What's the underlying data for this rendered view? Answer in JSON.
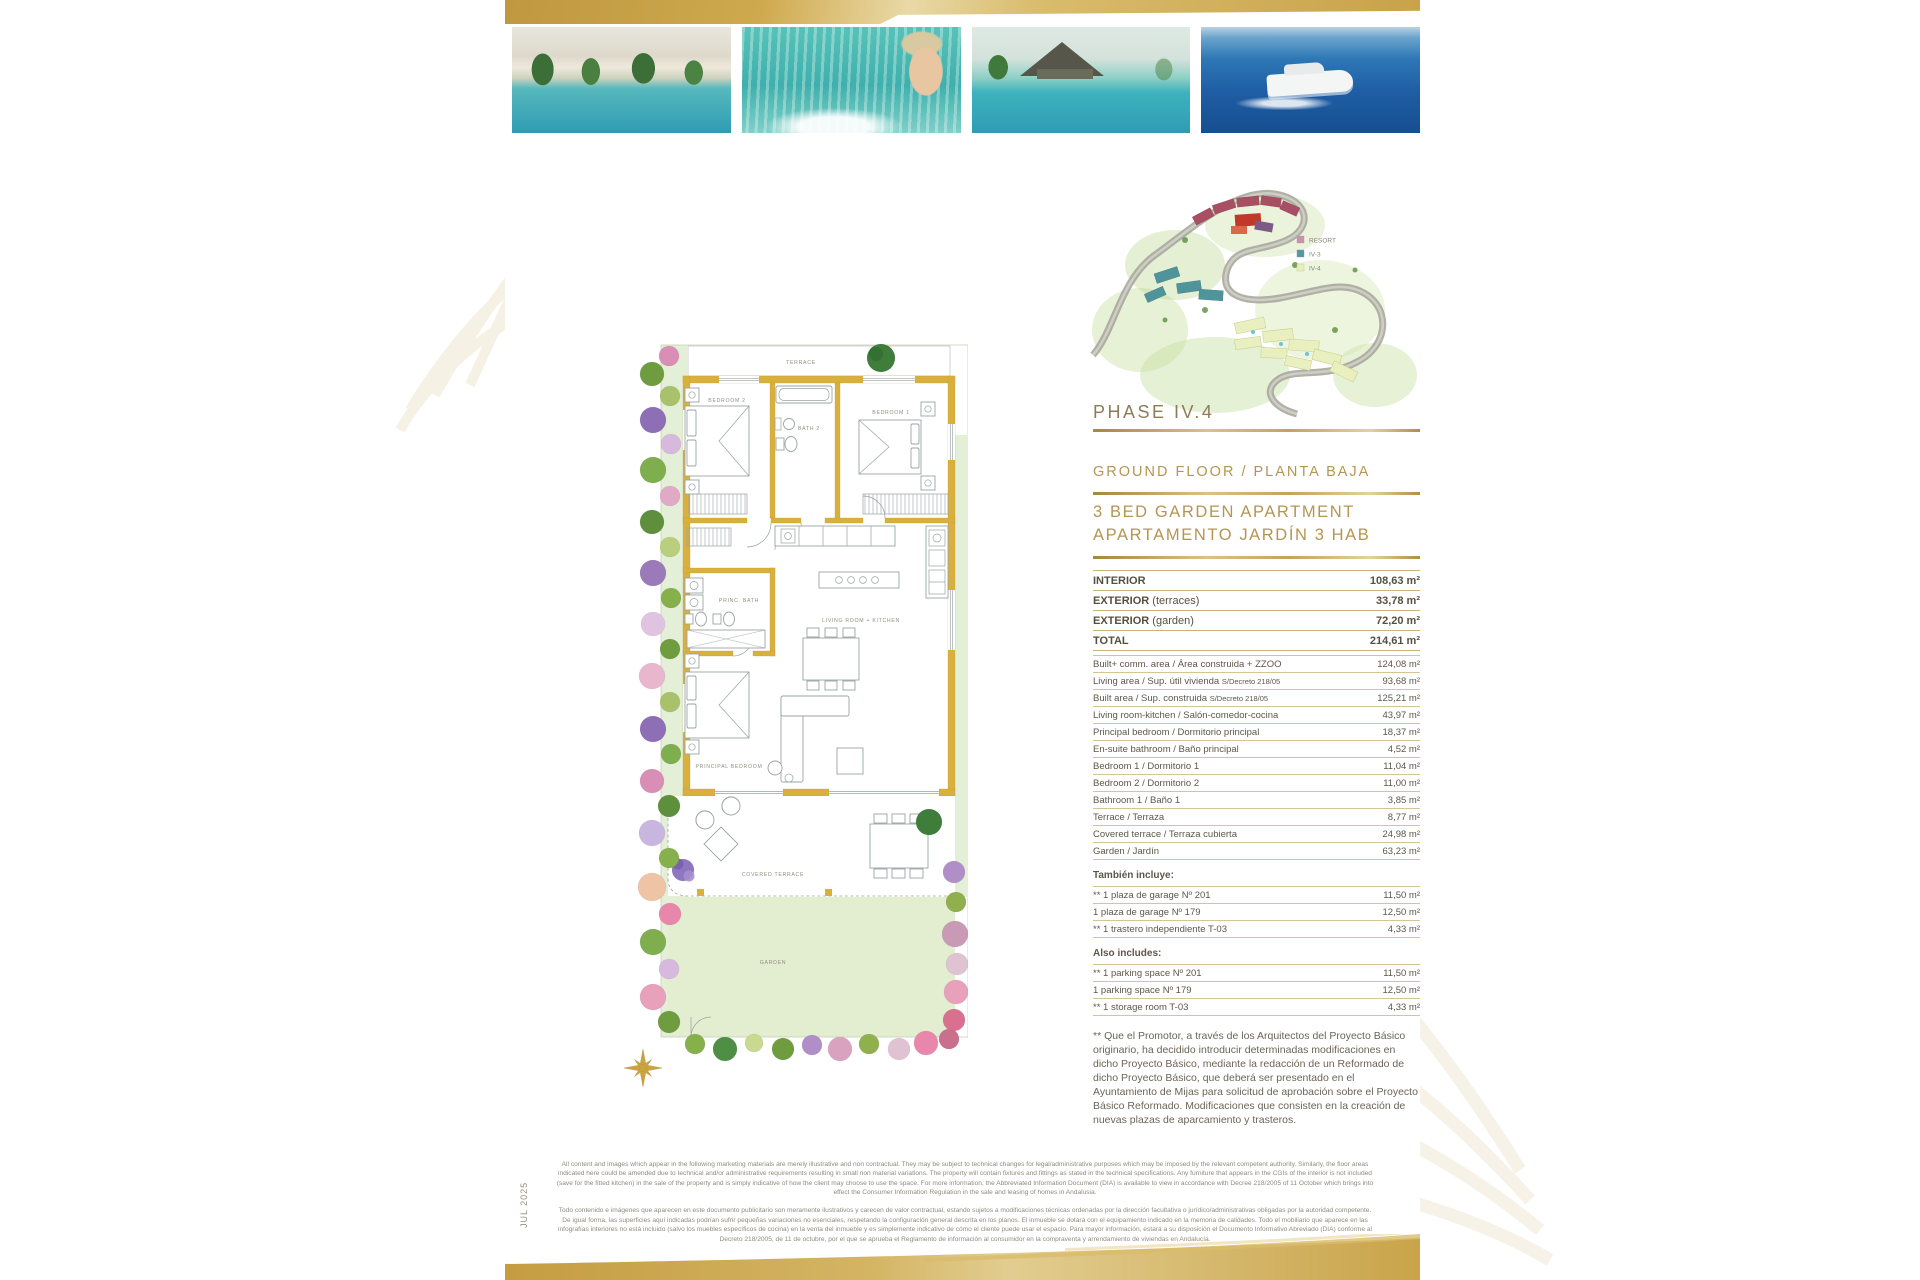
{
  "theme": {
    "gold": "#b59553",
    "gold-dark": "#a8863e",
    "wall-gold": "#d9af3e",
    "garden-green": "#e2eecf",
    "body-text": "#5d574a"
  },
  "meta": {
    "date_vertical": "JUL 2025"
  },
  "masterplan": {
    "phase_label": "PHASE IV.4",
    "legend": [
      {
        "label": "RESORT",
        "color": "#c992ab"
      },
      {
        "label": "IV-3",
        "color": "#55989f"
      },
      {
        "label": "IV-4",
        "color": "#e7eebb"
      }
    ]
  },
  "headings": {
    "floor_line": "GROUND FLOOR / PLANTA BAJA",
    "apartment_line1": "3 BED GARDEN APARTMENT",
    "apartment_line2": "APARTAMENTO JARDÍN 3 HAB"
  },
  "summary": {
    "rows": [
      {
        "label": "INTERIOR",
        "note": "",
        "value": "108,63 m²"
      },
      {
        "label": "EXTERIOR",
        "note": "(terraces)",
        "value": "33,78 m²"
      },
      {
        "label": "EXTERIOR",
        "note": "(garden)",
        "value": "72,20 m²"
      },
      {
        "label": "TOTAL",
        "note": "",
        "value": "214,61 m²"
      }
    ]
  },
  "details": {
    "rows": [
      {
        "label": "Built+ comm. area / Área construida + ZZOO",
        "value": "124,08 m²"
      },
      {
        "label": "Living area / Sup. útil vivienda",
        "small": "S/Decreto 218/05",
        "value": "93,68 m²"
      },
      {
        "label": "Built area / Sup. construida",
        "small": "S/Decreto 218/05",
        "value": "125,21 m²"
      },
      {
        "label": "Living room-kitchen / Salón-comedor-cocina",
        "value": "43,97 m²"
      },
      {
        "label": "Principal bedroom / Dormitorio principal",
        "value": "18,37 m²"
      },
      {
        "label": "En-suite bathroom / Baño principal",
        "value": "4,52 m²"
      },
      {
        "label": "Bedroom 1 / Dormitorio 1",
        "value": "11,04 m²"
      },
      {
        "label": "Bedroom 2 / Dormitorio 2",
        "value": "11,00 m²"
      },
      {
        "label": "Bathroom 1 / Baño 1",
        "value": "3,85 m²"
      },
      {
        "label": "Terrace / Terraza",
        "value": "8,77 m²"
      },
      {
        "label": "Covered terrace / Terraza cubierta",
        "value": "24,98 m²"
      },
      {
        "label": "Garden / Jardín",
        "value": "63,23 m²"
      }
    ]
  },
  "tambien": {
    "heading": "También incluye:",
    "rows": [
      {
        "label": "** 1 plaza de garage Nº 201",
        "value": "11,50 m²"
      },
      {
        "label": "1 plaza de garage Nº 179",
        "value": "12,50 m²"
      },
      {
        "label": "** 1 trastero independiente T-03",
        "value": "4,33 m²"
      }
    ]
  },
  "also": {
    "heading": "Also includes:",
    "rows": [
      {
        "label": "** 1 parking space Nº 201",
        "value": "11,50 m²"
      },
      {
        "label": "1 parking space Nº 179",
        "value": "12,50 m²"
      },
      {
        "label": "** 1 storage room T-03",
        "value": "4,33 m²"
      }
    ]
  },
  "footnote": "** Que el Promotor, a través de los Arquitectos del Proyecto Básico originario, ha decidido introducir determinadas modificaciones en dicho Proyecto Básico, mediante la redacción de un Reformado de dicho Proyecto Básico, que deberá ser presentado en el Ayuntamiento de Mijas para solicitud de aprobación sobre el Proyecto Básico Reformado. Modificaciones que consisten en la creación de nuevas plazas de aparcamiento y trasteros.",
  "floorplan": {
    "labels": {
      "terrace": "TERRACE",
      "bedroom2": "BEDROOM 2",
      "bath2": "BATH 2",
      "bedroom1": "BEDROOM 1",
      "princ_bath": "PRINC. BATH",
      "living": "LIVING ROOM + KITCHEN",
      "principal_bedroom": "PRINCIPAL BEDROOM",
      "covered_terrace": "COVERED TERRACE",
      "garden": "GARDEN"
    }
  },
  "legal": {
    "en": "All content and images which appear in the following marketing materials are merely illustrative and non contractual. They may be subject to technical changes for legal/administrative purposes which may be imposed by the relevant competent authority. Similarly, the floor areas indicated here could be amended due to technical and/or administrative requirements resulting in small non material variations. The property will contain fixtures and fittings as stated in the technical specifications. Any furniture that appears in the CGIs of the interior is not included (save for the fitted kitchen) in the sale of the property and is simply indicative of how the client may choose to use the space. For more information, the Abbreviated Information Document (DIA) is available to view in accordance with Decree 218/2005 of 11 October which brings into effect the Consumer Information Regulation in the sale and leasing of homes in Andalusia.",
    "es": "Todo contenido e imágenes que aparecen en este documento publicitario son meramente ilustrativos y carecen de valor contractual, estando sujetos a modificaciones técnicas ordenadas por la dirección facultativa o jurídico/administrativas obligadas por la autoridad competente. De igual forma, las superficies aquí indicadas podrían sufrir pequeñas variaciones no esenciales, respetando la configuración general descrita en los planos. El inmueble se dotará con el equipamiento indicado en la memoria de calidades. Todo el mobiliario que aparece en las infografías interiores no está incluido (salvo los muebles específicos de cocina) en la venta del inmueble y es simplemente indicativo de cómo el cliente puede usar el espacio. Para mayor información, estará a su disposición el Documento Informativo Abreviado (DIA) conforme al Decreto 218/2005, de 11 de octubre, por el que se aprueba el Reglamento de información al consumidor en la compraventa y arrendamiento de viviendas en Andalucía."
  }
}
